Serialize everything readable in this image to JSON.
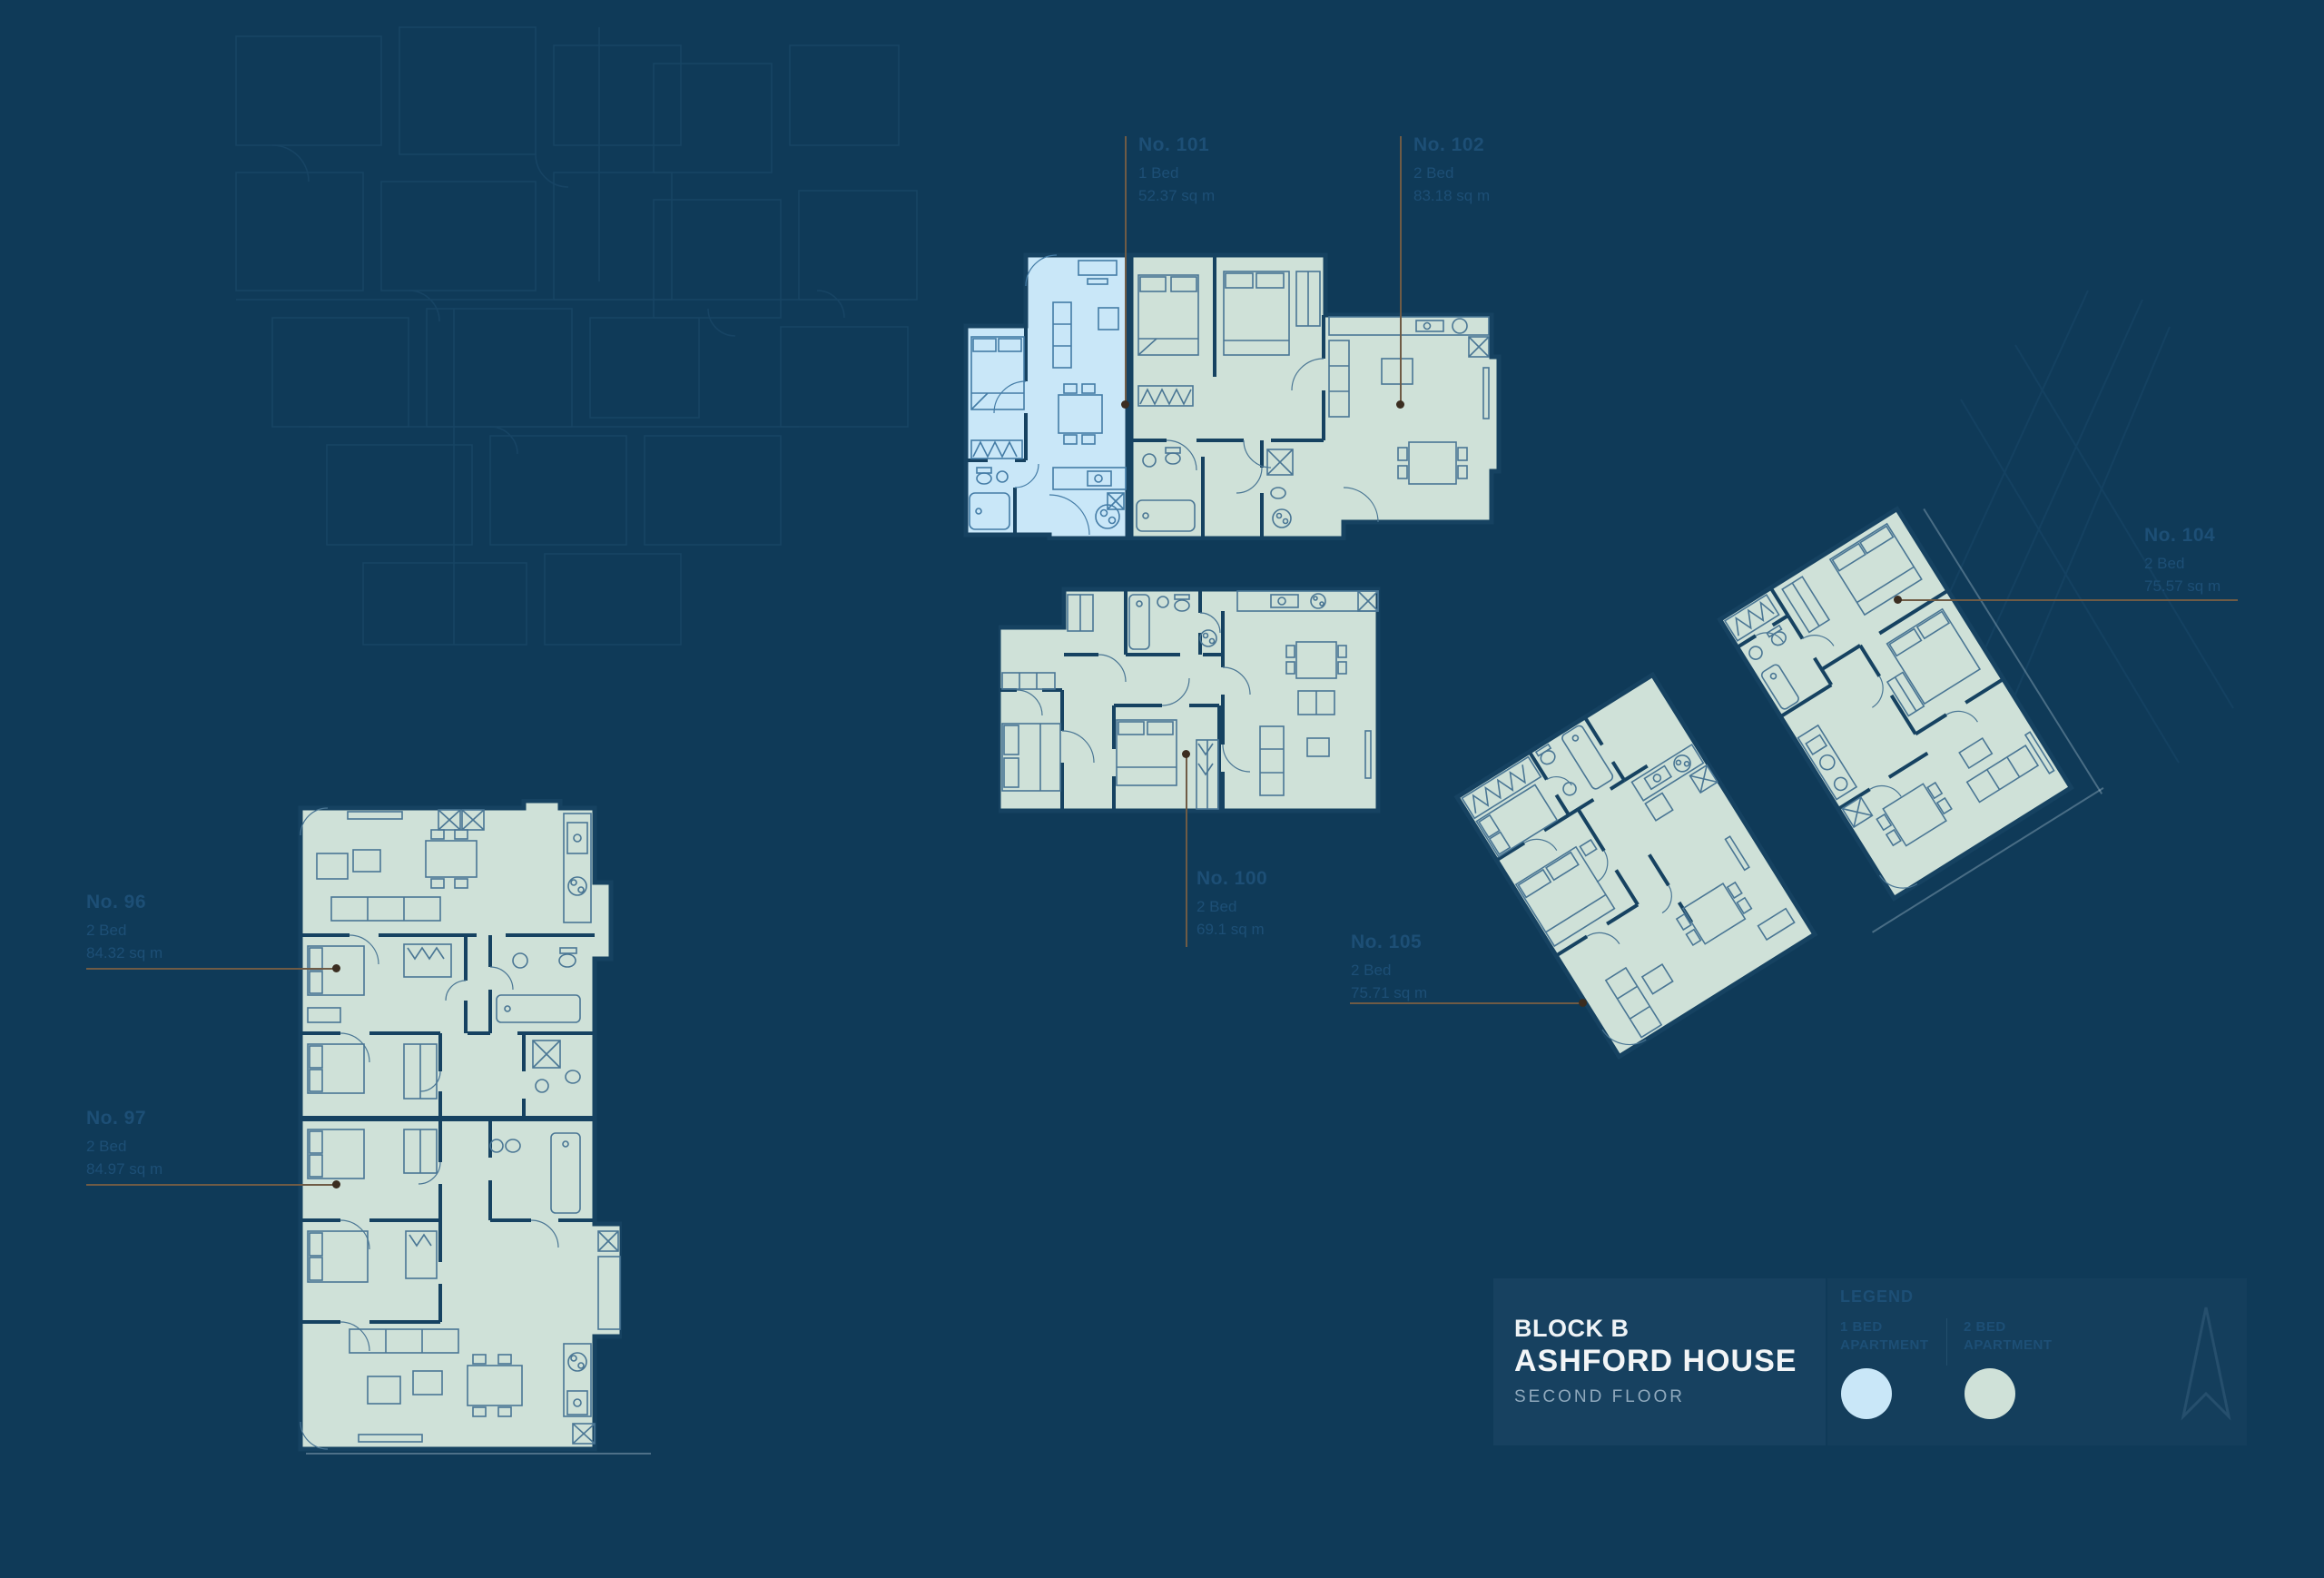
{
  "title_block": {
    "block": "BLOCK B",
    "building": "ASHFORD HOUSE",
    "floor": "SECOND FLOOR"
  },
  "legend": {
    "heading": "LEGEND",
    "items": [
      {
        "label_line1": "1 BED",
        "label_line2": "APARTMENT",
        "color": "#c9e7f8"
      },
      {
        "label_line1": "2 BED",
        "label_line2": "APARTMENT",
        "color": "#cfe1d8"
      }
    ]
  },
  "units": [
    {
      "no": "No. 101",
      "type": "1 Bed",
      "area": "52.37 sq m",
      "highlight": "#c9e7f8"
    },
    {
      "no": "No. 102",
      "type": "2 Bed",
      "area": "83.18 sq m",
      "highlight": "#cfe1d8"
    },
    {
      "no": "No. 96",
      "type": "2 Bed",
      "area": "84.32 sq m",
      "highlight": "#cfe1d8"
    },
    {
      "no": "No. 97",
      "type": "2 Bed",
      "area": "84.97 sq m",
      "highlight": "#cfe1d8"
    },
    {
      "no": "No. 100",
      "type": "2 Bed",
      "area": "69.1 sq m",
      "highlight": "#cfe1d8"
    },
    {
      "no": "No. 105",
      "type": "2 Bed",
      "area": "75.71 sq m",
      "highlight": "#cfe1d8"
    },
    {
      "no": "No. 104",
      "type": "2 Bed",
      "area": "75.57 sq m",
      "highlight": "#cfe1d8"
    }
  ],
  "colors": {
    "background": "#0f3a58",
    "one_bed_fill": "#c9e7f8",
    "two_bed_fill": "#cfe1d8",
    "wall": "#164261",
    "furniture_line": "#4a7694",
    "leader_line": "#6f5b45",
    "faint_label_text": "#1d4f76",
    "title_text": "#f2f5f7",
    "floor_text": "#8fa9bd"
  }
}
